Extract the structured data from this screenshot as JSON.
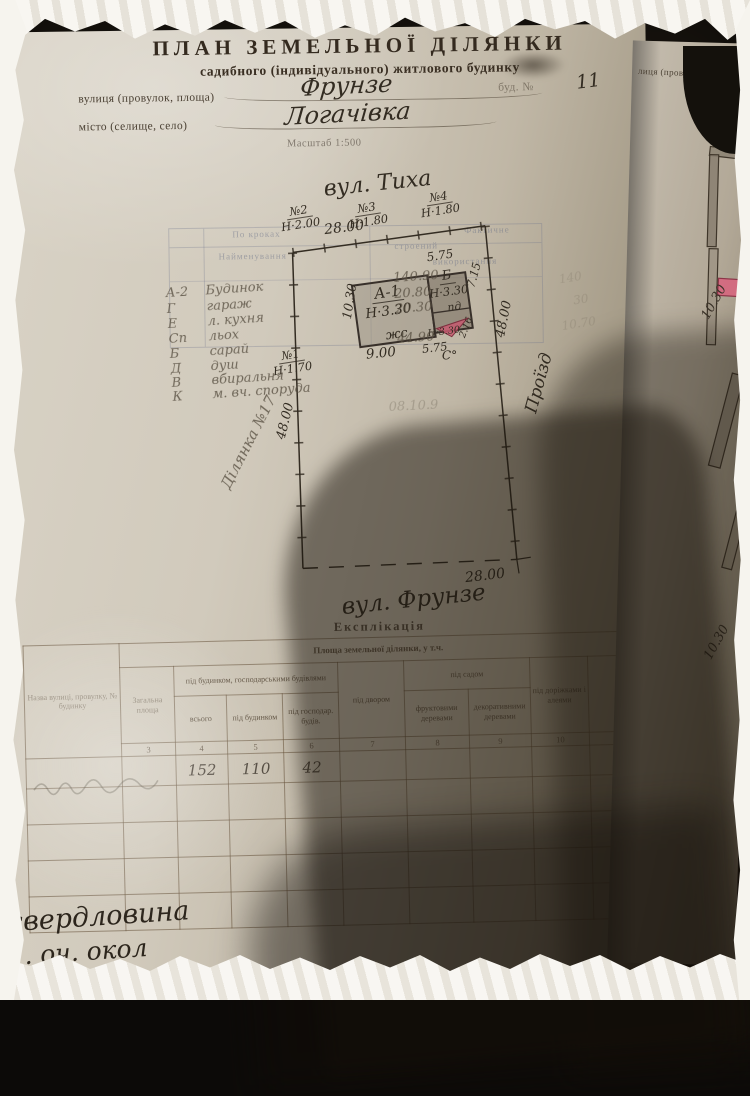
{
  "page": {
    "title": "ПЛАН  ЗЕМЕЛЬНОЇ  ДІЛЯНКИ",
    "subtitle": "садибного (індивідуального) житлового будинку",
    "street_label": "вулиця (провулок, площа)",
    "street_value": "Фрунзе",
    "house_label": "буд. №",
    "house_value": "11",
    "city_label": "місто (селище, село)",
    "city_value": "Логачівка",
    "scale_label": "Масштаб 1:500"
  },
  "plan": {
    "street_top": "вул. Тиха",
    "street_bottom": "вул. Фрунзе",
    "road_label": "Проїзд",
    "plot_label": "Ділянка №17",
    "dim_top": "28.00",
    "dim_bottom": "28.00",
    "dim_left": "48.00",
    "dim_right": "48.00",
    "north_mark": "С°",
    "poles": [
      {
        "id": "№1",
        "h": "Н·1.70"
      },
      {
        "id": "№2",
        "h": "Н·2.00"
      },
      {
        "id": "№3",
        "h": "Н·1.80"
      },
      {
        "id": "№4",
        "h": "Н·1.80"
      }
    ],
    "building": {
      "a_label": "А-1",
      "a_height": "Н·3.30",
      "a_note": "жс",
      "b_label": "Б",
      "b_height": "Н·3.30",
      "b_note": "пд",
      "porch_height": "Н·3.30",
      "dim_a_width": "9.00",
      "dim_a_height": "10.30",
      "dim_b_top": "5.75",
      "dim_b_right": "7.15",
      "dim_b_bottom": "5.75",
      "dim_porch": "2.16"
    },
    "pencil_rows": [
      {
        "letter": "А-2",
        "name": "Будинок",
        "area": "140.90"
      },
      {
        "letter": "Г",
        "name": "гараж",
        "area": "20.80"
      },
      {
        "letter": "Е",
        "name": "л. кухня",
        "area": "20.30"
      },
      {
        "letter": "Сп",
        "name": "льох",
        "area": ""
      },
      {
        "letter": "Б",
        "name": "сарай",
        "area": "44.90"
      },
      {
        "letter": "Д",
        "name": "душ",
        "area": ""
      },
      {
        "letter": "В",
        "name": "вбиральня",
        "area": ""
      },
      {
        "letter": "К",
        "name": "м. вч. споруда",
        "area": ""
      }
    ],
    "ghost_form": {
      "row1": "По кроках",
      "row2": "Найменування",
      "row3": "строений",
      "right1": "Фактичне",
      "right2": "використання"
    },
    "ghost_numbers": [
      "140",
      "30",
      "10.70"
    ],
    "pencil_date": "08.10.9"
  },
  "explication": {
    "title": "Експлікація",
    "area_header": "Площа земельної ділянки, у т.ч.",
    "col_name": "Назва ву­лиці, прову­лку, № бу­динку",
    "col_total_area": "Загальна площа",
    "group_buildings": "під будинком, господарськими будівлями",
    "sub_all": "всього",
    "sub_house": "під будинком",
    "sub_household": "під господар. будів.",
    "col_yard": "під двором",
    "group_garden": "під садом",
    "sub_fruit": "фруктовими деревами",
    "sub_decorative": "декоративними деревами",
    "col_paths": "під доріжками і алеями",
    "col_numbers": [
      "3",
      "4",
      "5",
      "6",
      "7",
      "8",
      "9",
      "10"
    ],
    "row_values": {
      "total": "152",
      "house": "110",
      "household": "42"
    },
    "note_line1": "свердловина",
    "note_line2": "1. оч. окол"
  },
  "page2": {
    "header": "лиця (провулок, площ",
    "dim_upper": "10.30",
    "dim_lower": "10.30"
  },
  "colors": {
    "paper": "#d1cabc",
    "ink": "#332c22",
    "pencil": "#58503f",
    "porch_red": "#c75a70",
    "pink_wall": "#d4697f",
    "photo_frame": "#f6f4ee",
    "shadow": "rgba(24,18,10,0.5)"
  }
}
